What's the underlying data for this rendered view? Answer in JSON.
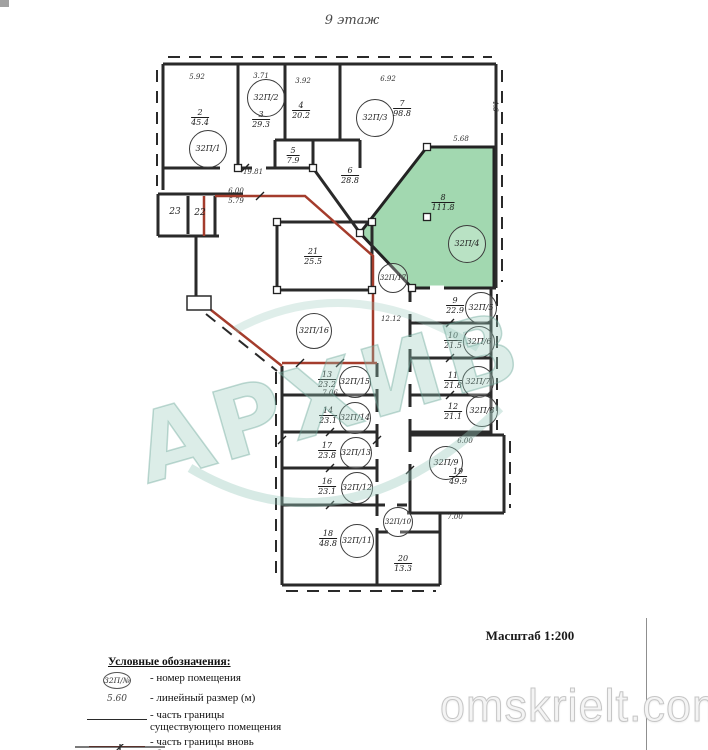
{
  "page": {
    "title": "9 этаж",
    "scale": "Масштаб 1:200",
    "archive_watermark": "АРХИВ",
    "site_watermark": "omskrielt.com"
  },
  "colors": {
    "wall": "#2a2a2a",
    "new_boundary": "#a43c2c",
    "highlight_room_fill": "#a2d8b0",
    "watermark_teal": "#96c8ba"
  },
  "legend": {
    "heading": "Условные обозначения:",
    "items": [
      {
        "symbol": "circle",
        "symbol_text": "32П/№",
        "label": "- номер помещения"
      },
      {
        "symbol": "text",
        "symbol_text": "5.60",
        "label": "- линейный размер (м)"
      },
      {
        "symbol": "line-black",
        "symbol_text": "",
        "label": "- часть границы\nсуществующего помещения"
      },
      {
        "symbol": "line-red",
        "symbol_text": "",
        "label": "- часть границы вновь\nобразованного помещения"
      }
    ]
  },
  "plan": {
    "unit_labels": [
      {
        "text": "32П/1",
        "x": 207,
        "y": 148,
        "r": 18
      },
      {
        "text": "32П/2",
        "x": 265,
        "y": 97,
        "r": 18
      },
      {
        "text": "32П/3",
        "x": 374,
        "y": 117,
        "r": 18
      },
      {
        "text": "32П/4",
        "x": 466,
        "y": 243,
        "r": 18
      },
      {
        "text": "32П/17",
        "x": 392,
        "y": 277,
        "r": 14
      },
      {
        "text": "32П/16",
        "x": 313,
        "y": 330,
        "r": 17
      },
      {
        "text": "32П/5",
        "x": 480,
        "y": 307,
        "r": 15
      },
      {
        "text": "32П/6",
        "x": 478,
        "y": 341,
        "r": 15
      },
      {
        "text": "32П/7",
        "x": 477,
        "y": 381,
        "r": 15
      },
      {
        "text": "32П/8",
        "x": 481,
        "y": 410,
        "r": 15
      },
      {
        "text": "32П/15",
        "x": 354,
        "y": 381,
        "r": 15
      },
      {
        "text": "32П/14",
        "x": 354,
        "y": 417,
        "r": 15
      },
      {
        "text": "32П/13",
        "x": 355,
        "y": 452,
        "r": 15
      },
      {
        "text": "32П/12",
        "x": 356,
        "y": 487,
        "r": 15
      },
      {
        "text": "32П/9",
        "x": 445,
        "y": 462,
        "r": 16
      },
      {
        "text": "32П/10",
        "x": 397,
        "y": 521,
        "r": 14
      },
      {
        "text": "32П/11",
        "x": 356,
        "y": 540,
        "r": 16
      }
    ],
    "area_labels": [
      {
        "num": "2",
        "den": "45.4",
        "x": 200,
        "y": 118
      },
      {
        "num": "3",
        "den": "29.3",
        "x": 261,
        "y": 120
      },
      {
        "num": "4",
        "den": "20.2",
        "x": 301,
        "y": 111
      },
      {
        "num": "7",
        "den": "98.8",
        "x": 402,
        "y": 109
      },
      {
        "num": "5",
        "den": "7.9",
        "x": 293,
        "y": 156
      },
      {
        "num": "6",
        "den": "28.8",
        "x": 350,
        "y": 176
      },
      {
        "num": "8",
        "den": "111.8",
        "x": 443,
        "y": 203
      },
      {
        "num": "21",
        "den": "25.5",
        "x": 313,
        "y": 257
      },
      {
        "num": "9",
        "den": "22.9",
        "x": 455,
        "y": 306
      },
      {
        "num": "10",
        "den": "21.5",
        "x": 453,
        "y": 341
      },
      {
        "num": "11",
        "den": "21.8",
        "x": 453,
        "y": 381
      },
      {
        "num": "12",
        "den": "21.1",
        "x": 453,
        "y": 412
      },
      {
        "num": "13",
        "den": "23.2",
        "x": 327,
        "y": 380
      },
      {
        "num": "14",
        "den": "23.1",
        "x": 328,
        "y": 416
      },
      {
        "num": "17",
        "den": "23.8",
        "x": 327,
        "y": 451
      },
      {
        "num": "16",
        "den": "23.1",
        "x": 327,
        "y": 487
      },
      {
        "num": "18",
        "den": "48.8",
        "x": 328,
        "y": 539
      },
      {
        "num": "19",
        "den": "49.9",
        "x": 458,
        "y": 477
      },
      {
        "num": "20",
        "den": "13.3",
        "x": 403,
        "y": 564
      }
    ],
    "room_numbers": [
      {
        "text": "23",
        "x": 175,
        "y": 212
      },
      {
        "text": "22",
        "x": 200,
        "y": 213
      }
    ],
    "dim_labels": [
      {
        "text": "5.92",
        "x": 197,
        "y": 77,
        "rot": 0
      },
      {
        "text": "3.71",
        "x": 261,
        "y": 76,
        "rot": 0
      },
      {
        "text": "3.92",
        "x": 303,
        "y": 81,
        "rot": 0
      },
      {
        "text": "6.92",
        "x": 388,
        "y": 79,
        "rot": 0
      },
      {
        "text": "4.6",
        "x": 495,
        "y": 106,
        "rot": 90
      },
      {
        "text": "5.68",
        "x": 461,
        "y": 139,
        "rot": 0
      },
      {
        "text": "19.81",
        "x": 253,
        "y": 172,
        "rot": 0
      },
      {
        "text": "6.00",
        "x": 236,
        "y": 191,
        "rot": 0
      },
      {
        "text": "5.79",
        "x": 236,
        "y": 201,
        "rot": 0
      },
      {
        "text": "12.12",
        "x": 391,
        "y": 319,
        "rot": 0
      },
      {
        "text": "7.06",
        "x": 330,
        "y": 393,
        "rot": 0
      },
      {
        "text": "6.00",
        "x": 465,
        "y": 441,
        "rot": 0
      },
      {
        "text": "7.00",
        "x": 455,
        "y": 517,
        "rot": 0
      }
    ]
  }
}
